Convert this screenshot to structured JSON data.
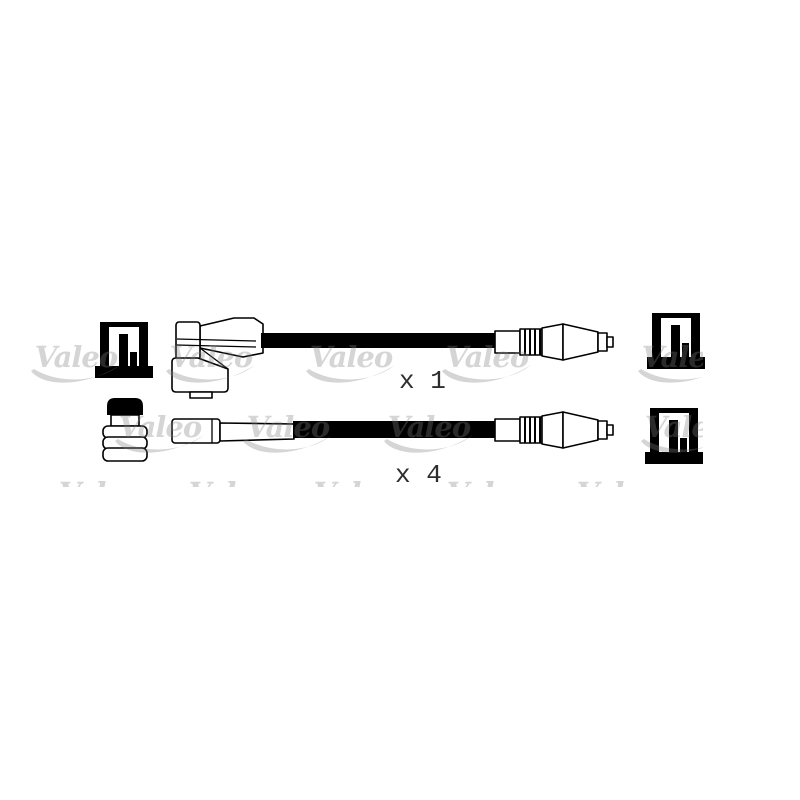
{
  "page": {
    "width": 800,
    "height": 800,
    "background": "#ffffff"
  },
  "illustration": {
    "description": "ignition cable kit line drawing",
    "line_color": "#000000",
    "fill_color": "#ffffff",
    "items": [
      {
        "id": "cable-single",
        "quantity_label": "x 1"
      },
      {
        "id": "cable-set",
        "quantity_label": "x 4"
      }
    ]
  },
  "watermark": {
    "text": "Valeo",
    "base_color": "#808080",
    "opacity": 0.33,
    "tone_on_white": "#d6d6d6",
    "band": {
      "x": 0,
      "y": 311,
      "width": 703,
      "height": 176
    },
    "rows": [
      {
        "text_top": 270,
        "centers": [
          140,
          262,
          395,
          520,
          650
        ]
      },
      {
        "text_top": 343,
        "centers": [
          76,
          211,
          351,
          487,
          683
        ]
      },
      {
        "text_top": 413,
        "centers": [
          160,
          288,
          429,
          686
        ]
      },
      {
        "text_top": 479,
        "centers": [
          100,
          230,
          355,
          488,
          618,
          745
        ]
      }
    ]
  }
}
